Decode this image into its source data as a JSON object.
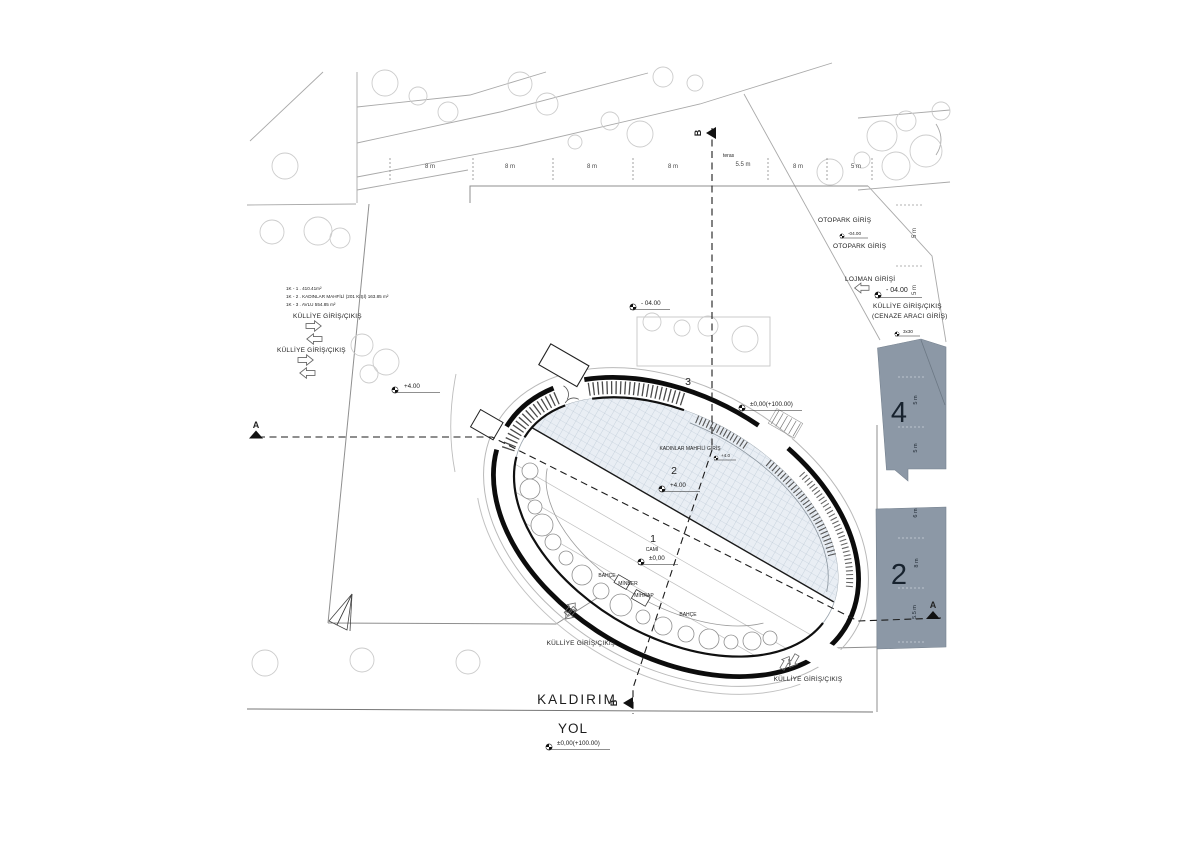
{
  "legend": {
    "line1": "1K - 1 . 410.41m²",
    "line2": "1K - 2 . KADINLAR MAHFİLİ (201 KİŞİ) 163.85 m²",
    "line3": "1K - 3 . AVLU 554.85 m²"
  },
  "entrances": {
    "kulliye_left_top": "KÜLLİYE GİRİŞ/ÇIKIŞ",
    "kulliye_left_mid": "KÜLLİYE GİRİŞ/ÇIKIŞ",
    "kulliye_bottom_left": "KÜLLİYE GİRİŞ/ÇIKIŞ",
    "kulliye_bottom_right": "KÜLLİYE GİRİŞ/ÇIKIŞ",
    "kadinlar": "KADINLAR MAHFİLİ GİRİŞ",
    "otopark1": "OTOPARK GİRİŞ",
    "otopark2": "OTOPARK GİRİŞ",
    "lojman": "LOJMAN GİRİŞİ",
    "kulliye_right": "KÜLLİYE GİRİŞ/ÇIKIŞ",
    "cenaze": "(CENAZE ARACI GİRİŞ)"
  },
  "elevations": {
    "plus4_left": "+4.00",
    "minus4_top": "- 04.00",
    "zero_top": "±0,00(+100.00)",
    "plus4_court": "+4.00",
    "zero_cami": "±0,00",
    "zero_road": "±0,00(+100.00)",
    "minus4_right": "- 04.00",
    "minus4_small": "-04.00",
    "steps_small": "3x30",
    "kadinlar_small": "+4.0"
  },
  "zones": {
    "z1": "1",
    "z1_name": "CAMİ",
    "z2": "2",
    "z3": "3",
    "block4": "4",
    "block2": "2"
  },
  "rooms": {
    "bahce1": "BAHÇE",
    "minber": "MİNBER",
    "mihrap": "MİHRAP",
    "bahce2": "BAHÇE"
  },
  "roads": {
    "kaldirim": "KALDIRIM",
    "yol": "YOL",
    "teras": "teras"
  },
  "sections": {
    "a": "A",
    "b": "B"
  },
  "dimensions": {
    "top": [
      {
        "label": "8 m"
      },
      {
        "label": "8 m"
      },
      {
        "label": "8 m"
      },
      {
        "label": "8 m"
      },
      {
        "label": "5.5 m"
      },
      {
        "label": "8 m"
      },
      {
        "label": "5 m"
      }
    ],
    "right": [
      {
        "label": "5 m"
      },
      {
        "label": "5 m"
      },
      {
        "label": "5 m"
      },
      {
        "label": "5 m"
      },
      {
        "label": "6 m"
      },
      {
        "label": "8 m"
      },
      {
        "label": "5.5 m"
      }
    ]
  },
  "colors": {
    "block_fill": "#8c98a6",
    "grid_fill": "#e9eef4",
    "grid_line": "#b3c1cf",
    "ring": "#0c0c0c"
  }
}
